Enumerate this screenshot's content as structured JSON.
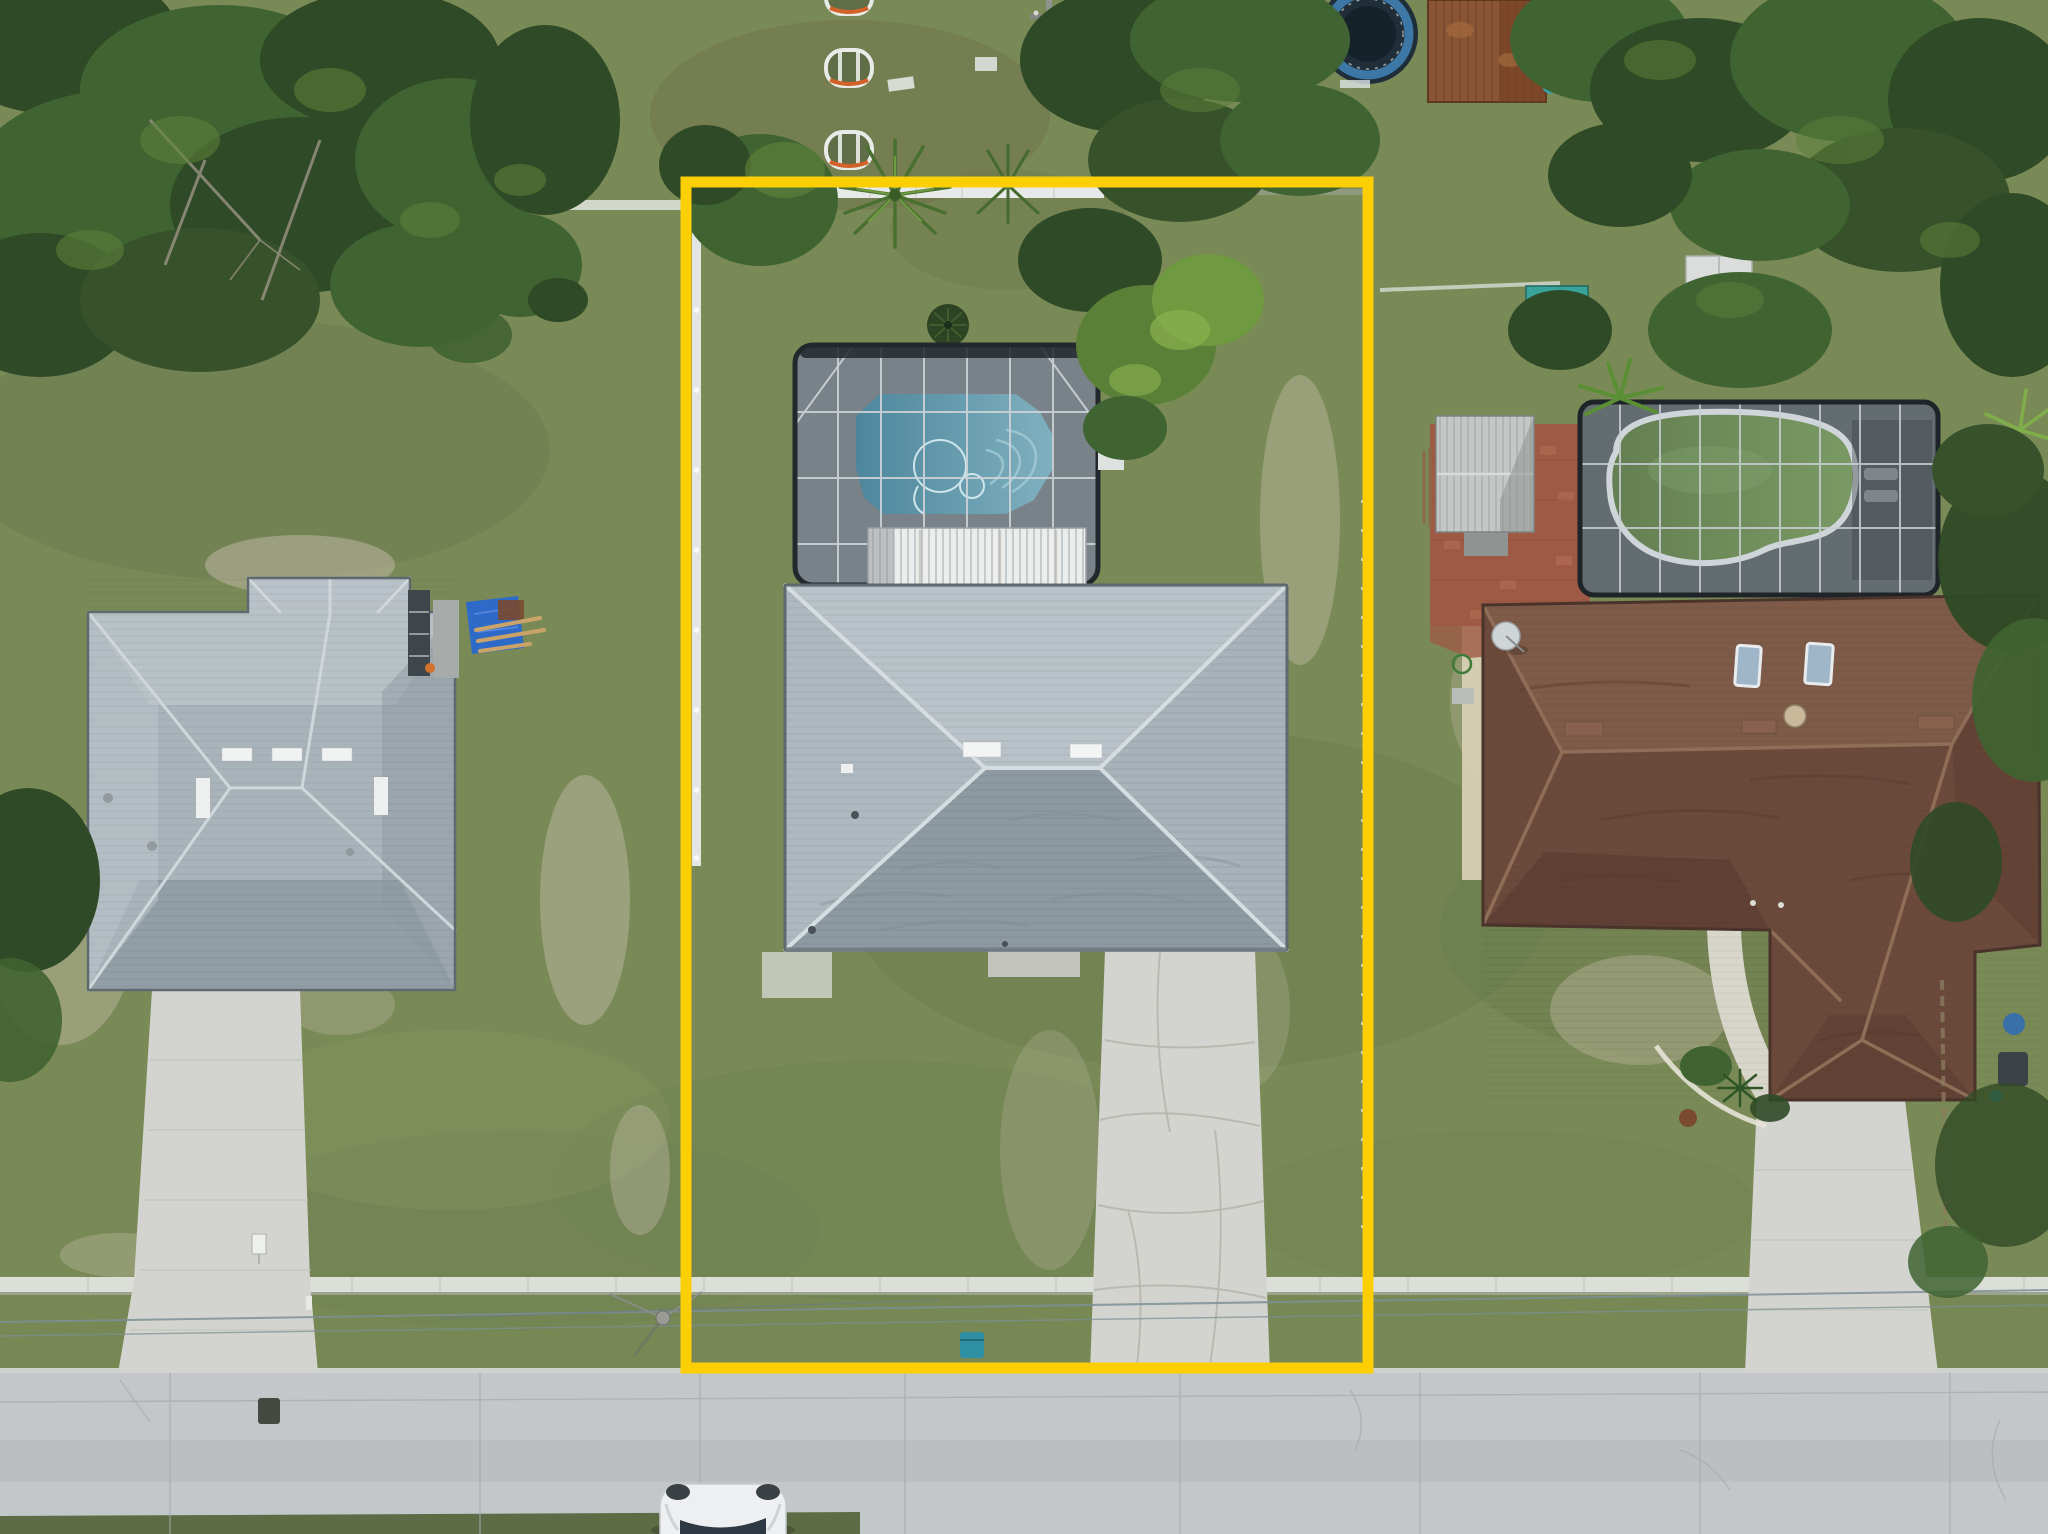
{
  "meta": {
    "title": "Aerial drone photo of residential property",
    "type": "drone-photograph",
    "description": "Top-down aerial view of a single-family home lot outlined with a yellow property-boundary overlay. The subject lot contains a gray hip-roof house, a screened pool enclosure with a blue pool, a white-paneled lanai roof, a long concrete driveway to the street, and a white side fence. Neighboring homes: left house with gray hip roof and driveway; right house with brown shingle roof, screened enclosure with green pool, metal shed, brick patio and driveway. A street with sidewalk, power lines, utility pole and a white car runs along the bottom. Trees border the top and sides; a trampoline, rusty shed and teal board sit top-right; three oval planters top-center."
  },
  "scene": {
    "boundary": {
      "label": "property-boundary-outline",
      "color": "#fbcf04"
    },
    "colors": {
      "grass": "#7a8a57",
      "grass_dark": "#63744a",
      "sand": "#b7b39c",
      "street": "#c4c7c9",
      "sidewalk": "#dcded8",
      "driveway": "#d3d4cf",
      "fence": "#e8eae9",
      "center_roof": "#a2aeb5",
      "center_roof_light": "#b9c2c8",
      "center_roof_dark": "#8d9aa2",
      "pool_blue": "#4d869c",
      "pool_blue_light": "#7fb0bf",
      "lanai": "#eceeee",
      "enclosure": "#454d53",
      "left_roof": "#a9b3ba",
      "brown_roof": "#6b4a3c",
      "pool_green": "#647f52",
      "pool_green_light": "#7a9a64",
      "brick": "#9e5a45",
      "shed": "#c3c7c6",
      "tarp": "#2e6bc8",
      "trampoline_ring": "#3f7fb3",
      "car": "#edeff0",
      "tree": "#406332",
      "wire": "#7d9096"
    },
    "objects": {
      "subject_lot": [
        "yellow-boundary",
        "gray-hip-roof-house",
        "screened-pool-enclosure",
        "blue-pool",
        "lanai-roof",
        "white-side-fence",
        "concrete-driveway",
        "ac-pad",
        "cycad-bush",
        "palm-trees"
      ],
      "left_lot": [
        "gray-hip-roof-house",
        "screened-bay",
        "blue-tarp",
        "lumber-pile",
        "driveway"
      ],
      "right_lot": [
        "brown-roof-house",
        "screened-pool-enclosure",
        "green-pool",
        "metal-shed",
        "brick-patio",
        "skylights",
        "satellite-dish",
        "driveway",
        "front-landscaping"
      ],
      "street_zone": [
        "street",
        "sidewalk",
        "power-lines",
        "utility-pole",
        "white-car",
        "yard-sign",
        "trash-bin",
        "recycle-bin"
      ],
      "top_strip": [
        "oval-planters",
        "trampoline",
        "rusty-shed",
        "teal-board",
        "teal-shed-roof",
        "white-shed",
        "power-pole",
        "tree-canopy"
      ]
    }
  }
}
